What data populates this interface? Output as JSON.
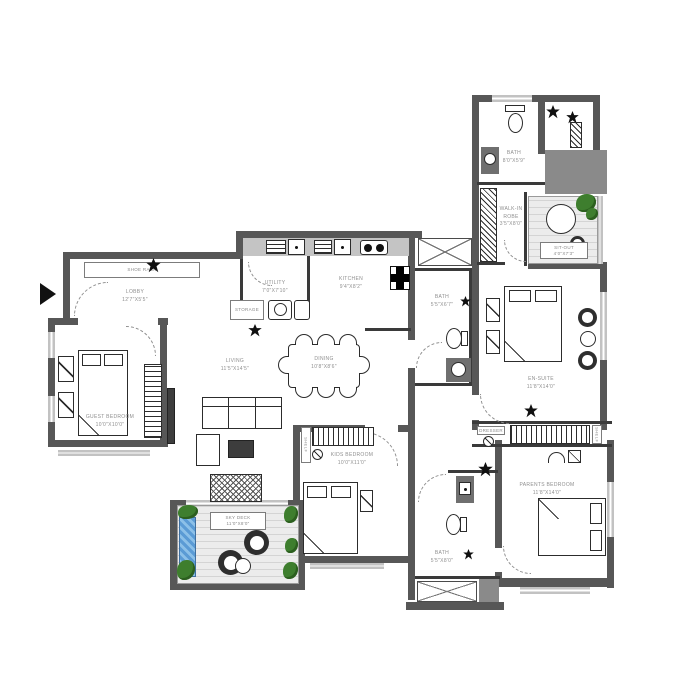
{
  "title": "Apartment Floor Plan",
  "colors": {
    "wall": "#575757",
    "plant_green": "#3e7e2e",
    "water_blue": "#5b9bd5",
    "counter_gray": "#c4c4c4"
  },
  "rooms": {
    "lobby": {
      "name": "LOBBY",
      "dim": "12'7\"X5'5\""
    },
    "guest_bedroom": {
      "name": "GUEST BEDROOM",
      "dim": "10'0\"X10'0\""
    },
    "living": {
      "name": "LIVING",
      "dim": "11'5\"X14'5\""
    },
    "dining": {
      "name": "DINING",
      "dim": "10'8\"X8'6\""
    },
    "utility": {
      "name": "UTILITY",
      "dim": "7'0\"X7'10\""
    },
    "kitchen": {
      "name": "KITCHEN",
      "dim": "9'4\"X8'2\""
    },
    "bath_mid": {
      "name": "BATH",
      "dim": "5'5\"X6'7\""
    },
    "bath_top": {
      "name": "BATH",
      "dim": "8'0\"X5'9\""
    },
    "walk_in_robe": {
      "name": "WALK-IN ROBE",
      "dim": "3'5\"X8'0\""
    },
    "sit_out": {
      "name": "SIT-OUT",
      "dim": "4'0\"X7'3\""
    },
    "en_suite": {
      "name": "EN-SUITE",
      "dim": "11'8\"X14'0\""
    },
    "kids_bedroom": {
      "name": "KIDS BEDROOM",
      "dim": "10'0\"X11'0\""
    },
    "parents_bedroom": {
      "name": "PARENTS BEDROOM",
      "dim": "11'8\"X14'0\""
    },
    "bath_bottom": {
      "name": "BATH",
      "dim": "5'5\"X8'0\""
    },
    "sky_deck": {
      "name": "SKY DECK",
      "dim": "11'0\"X8'0\""
    }
  },
  "fixtures": {
    "shoe_rack": "SHOE RACK",
    "storage": "STORAGE",
    "dresser": "DRESSER",
    "shelf_kids": "SHELF",
    "shelf_parents": "SHELF"
  }
}
